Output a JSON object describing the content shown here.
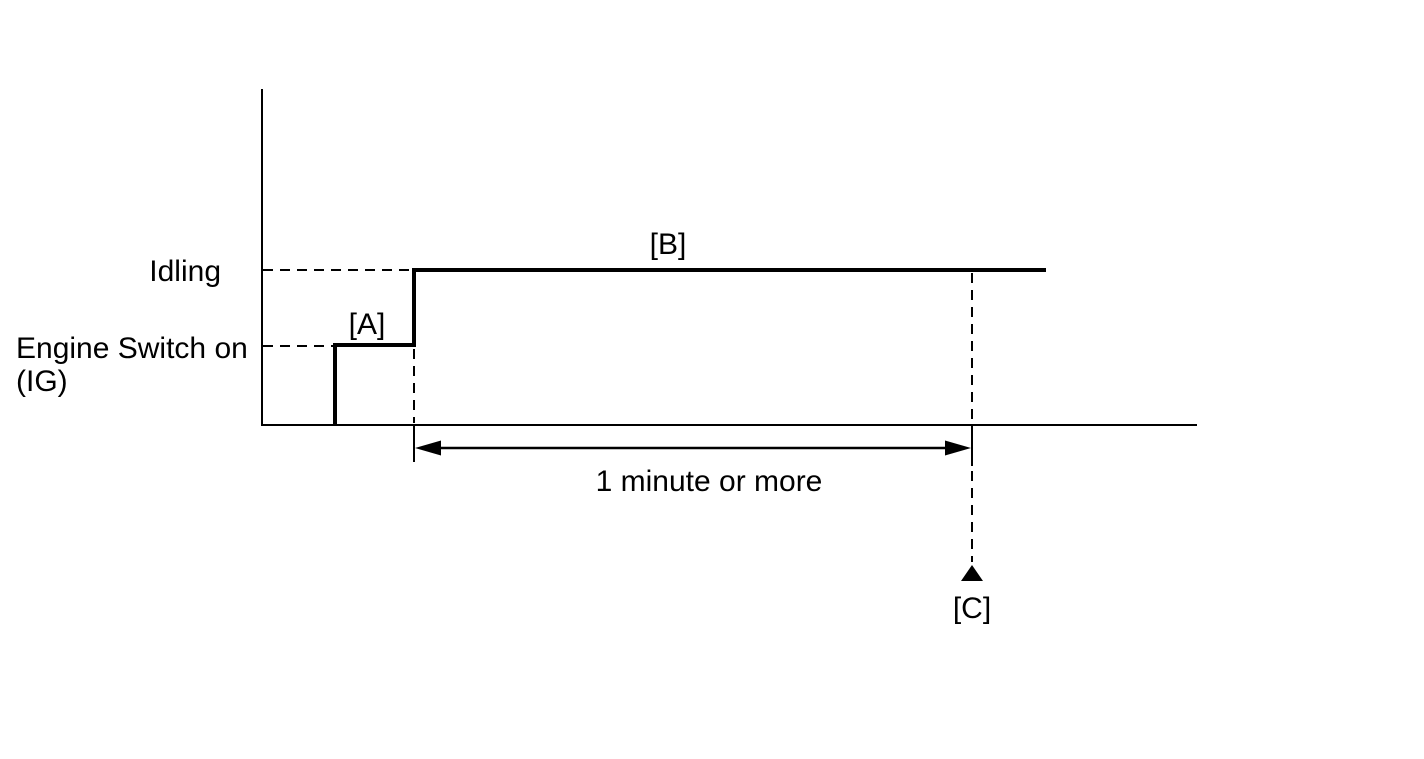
{
  "page": {
    "background_color": "#ffffff",
    "line_color": "#000000"
  },
  "diagram": {
    "type": "timing-diagram",
    "levels": [
      {
        "id": "idling",
        "label": "Idling"
      },
      {
        "id": "engine-switch-on",
        "label_line1": "Engine Switch on",
        "label_line2": "(IG)"
      }
    ],
    "markers": {
      "a": "[A]",
      "b": "[B]",
      "c": "[C]"
    },
    "duration_label": "1 minute or more",
    "annotations": [
      {
        "text": "[A]",
        "attached_to": "engine-switch-on-step"
      },
      {
        "text": "[B]",
        "attached_to": "idling-plateau"
      },
      {
        "text": "[C]",
        "attached_to": "end-of-duration-pointer"
      }
    ],
    "sequence_levels": [
      "off",
      "engine-switch-on",
      "idling"
    ],
    "duration_span": {
      "from": "start-of-idling",
      "to": "marker-c",
      "label": "1 minute or more"
    }
  }
}
